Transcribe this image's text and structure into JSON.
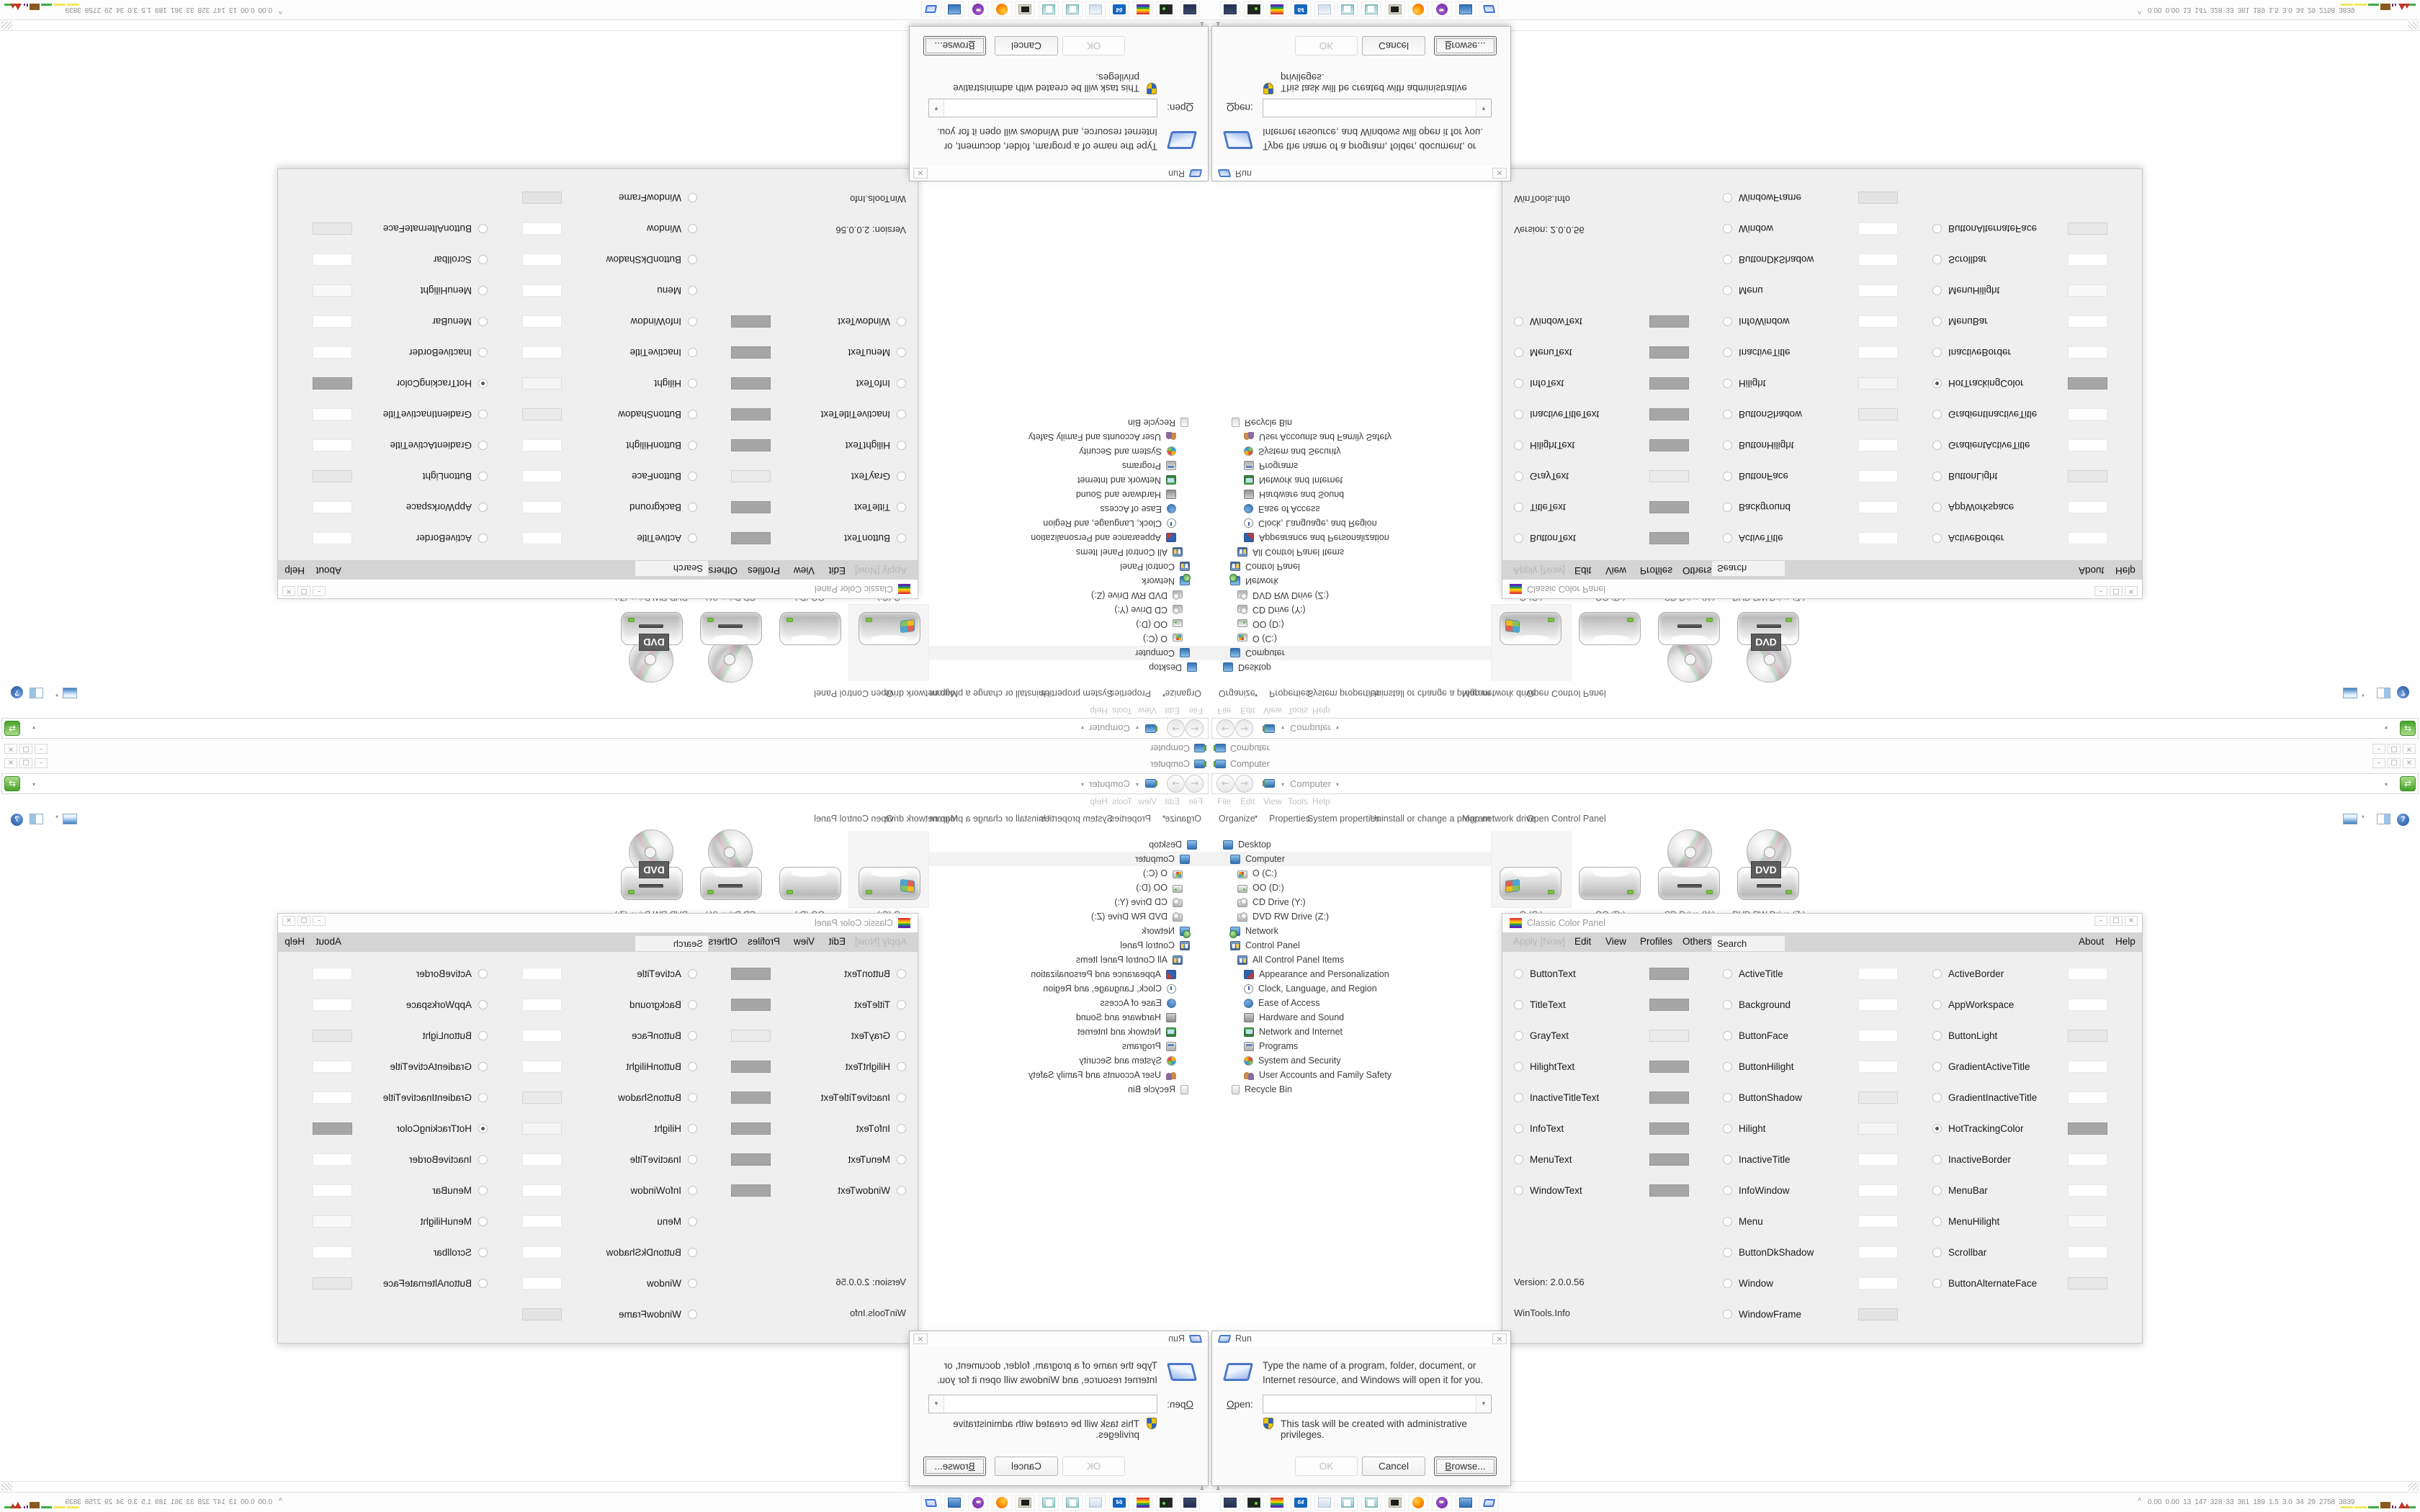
{
  "icons": {
    "minimize": "–",
    "maximize": "□",
    "close": "×",
    "dropdown": "▾",
    "back": "←",
    "forward": "→",
    "help": "?",
    "refresh": "⇄",
    "tray_chevron": "^"
  },
  "explorer": {
    "title": "Computer",
    "breadcrumb": "Computer",
    "menu": [
      "File",
      "Edit",
      "View",
      "Tools",
      "Help"
    ],
    "toolbar": [
      "Organize",
      "Properties",
      "System properties",
      "Uninstall or change a program",
      "Map network drive",
      "Open Control Panel"
    ],
    "tree": [
      {
        "label": "Desktop",
        "level": 0,
        "icon": "desktop-icon"
      },
      {
        "label": "Computer",
        "level": 1,
        "icon": "computer-icon",
        "selected": true
      },
      {
        "label": "O (C:)",
        "level": 2,
        "icon": "windows-drive-icon"
      },
      {
        "label": "OO (D:)",
        "level": 2,
        "icon": "hard-drive-icon"
      },
      {
        "label": "CD Drive (Y:)",
        "level": 2,
        "icon": "optical-drive-icon"
      },
      {
        "label": "DVD RW Drive (Z:)",
        "level": 2,
        "icon": "optical-drive-icon"
      },
      {
        "label": "Network",
        "level": 1,
        "icon": "network-icon"
      },
      {
        "label": "Control Panel",
        "level": 1,
        "icon": "control-panel-icon"
      },
      {
        "label": "All Control Panel Items",
        "level": 2,
        "icon": "control-panel-icon"
      },
      {
        "label": "Appearance and Personalization",
        "level": 3,
        "icon": "appearance-icon"
      },
      {
        "label": "Clock, Language, and Region",
        "level": 3,
        "icon": "clock-icon"
      },
      {
        "label": "Ease of Access",
        "level": 3,
        "icon": "ease-of-access-icon"
      },
      {
        "label": "Hardware and Sound",
        "level": 3,
        "icon": "hardware-icon"
      },
      {
        "label": "Network and Internet",
        "level": 3,
        "icon": "network-internet-icon"
      },
      {
        "label": "Programs",
        "level": 3,
        "icon": "programs-icon"
      },
      {
        "label": "System and Security",
        "level": 3,
        "icon": "system-security-icon"
      },
      {
        "label": "User Accounts and Family Safety",
        "level": 3,
        "icon": "user-accounts-icon"
      },
      {
        "label": "Recycle Bin",
        "level": 1,
        "icon": "recycle-bin-icon"
      }
    ],
    "drives": [
      {
        "label": "O (C:)",
        "type": "hdd-windows",
        "selected": true
      },
      {
        "label": "OO (D:)",
        "type": "hdd",
        "selected": false
      },
      {
        "label": "CD Drive (Y:)",
        "type": "cd",
        "selected": false
      },
      {
        "label": "DVD RW Drive (Z:)",
        "type": "dvd",
        "selected": false,
        "badge": "DVD"
      }
    ],
    "status": "1"
  },
  "color_panel": {
    "title": "Classic Color Panel",
    "menu": {
      "apply": "Apply [Now]",
      "edit": "Edit",
      "view": "View",
      "profiles": "Profiles",
      "others": "Others",
      "search": "Search",
      "about": "About",
      "help": "Help"
    },
    "col1": [
      {
        "label": "ButtonText",
        "color": "#a6a6a6"
      },
      {
        "label": "TitleText",
        "color": "#a6a6a6"
      },
      {
        "label": "GrayText",
        "color": "#eaeaea"
      },
      {
        "label": "HilightText",
        "color": "#a6a6a6"
      },
      {
        "label": "InactiveTitleText",
        "color": "#a6a6a6"
      },
      {
        "label": "InfoText",
        "color": "#a6a6a6"
      },
      {
        "label": "MenuText",
        "color": "#a6a6a6"
      },
      {
        "label": "WindowText",
        "color": "#a6a6a6"
      }
    ],
    "col2": [
      {
        "label": "ActiveTitle",
        "color": "#ffffff"
      },
      {
        "label": "Background",
        "color": "#ffffff"
      },
      {
        "label": "ButtonFace",
        "color": "#ffffff"
      },
      {
        "label": "ButtonHilight",
        "color": "#ffffff"
      },
      {
        "label": "ButtonShadow",
        "color": "#eaeaea"
      },
      {
        "label": "Hilight",
        "color": "#f5f5f5"
      },
      {
        "label": "InactiveTitle",
        "color": "#ffffff"
      },
      {
        "label": "InfoWindow",
        "color": "#ffffff"
      },
      {
        "label": "Menu",
        "color": "#ffffff"
      },
      {
        "label": "ButtonDkShadow",
        "color": "#ffffff"
      },
      {
        "label": "Window",
        "color": "#ffffff"
      },
      {
        "label": "WindowFrame",
        "color": "#e3e3e3"
      }
    ],
    "col3": [
      {
        "label": "ActiveBorder",
        "color": "#ffffff"
      },
      {
        "label": "AppWorkspace",
        "color": "#ffffff"
      },
      {
        "label": "ButtonLight",
        "color": "#e8e8e8"
      },
      {
        "label": "GradientActiveTitle",
        "color": "#ffffff"
      },
      {
        "label": "GradientInactiveTitle",
        "color": "#ffffff"
      },
      {
        "label": "HotTrackingColor",
        "color": "#a6a6a6",
        "selected": true
      },
      {
        "label": "InactiveBorder",
        "color": "#ffffff"
      },
      {
        "label": "MenuBar",
        "color": "#ffffff"
      },
      {
        "label": "MenuHilight",
        "color": "#f9f9f9"
      },
      {
        "label": "Scrollbar",
        "color": "#ffffff"
      },
      {
        "label": "ButtonAlternateFace",
        "color": "#e8e8e8"
      }
    ],
    "version": "Version: 2.0.0.56",
    "site": "WinTools.Info"
  },
  "run_dialog": {
    "title": "Run",
    "message": "Type the name of a program, folder, document, or Internet resource, and Windows will open it for you.",
    "open_label": "Open:",
    "open_value": "",
    "admin_note": "This task will be created with administrative privileges.",
    "ok": "OK",
    "cancel": "Cancel",
    "browse": "Browse..."
  },
  "taskbar": {
    "buttons": [
      {
        "icon": "display-settings-icon"
      },
      {
        "icon": "disk-utility-icon"
      },
      {
        "icon": "color-panel-icon"
      },
      {
        "icon": "floppy-64-icon"
      },
      {
        "icon": "document-icon"
      },
      {
        "icon": "notepad-icon"
      },
      {
        "icon": "notepad-icon"
      },
      {
        "icon": "terminal-icon"
      },
      {
        "icon": "firefox-icon"
      },
      {
        "icon": "media-app-icon"
      },
      {
        "icon": "computer-icon"
      },
      {
        "icon": "run-icon"
      }
    ],
    "floppy_label": "64",
    "tray_stats": [
      "0.00",
      "0.00",
      "13",
      "147",
      "328",
      "33",
      "361",
      "189",
      "1.5",
      "3.0",
      "34",
      "29",
      "2758",
      "3839"
    ]
  }
}
